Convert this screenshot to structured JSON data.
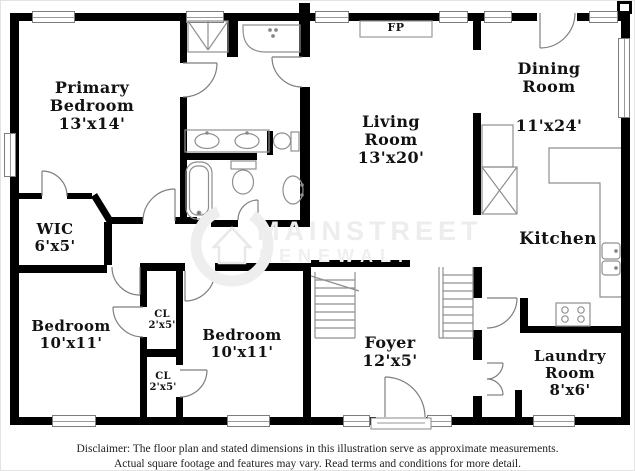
{
  "colors": {
    "wall": "#000000",
    "fixture_line": "#8f8f8f",
    "watermark": "#ededed",
    "label_text": "#121212"
  },
  "watermark": {
    "line1": "MAINSTREET",
    "line2": "RENEWAL."
  },
  "fireplace": {
    "label": "FP"
  },
  "rooms": {
    "primary_bedroom": {
      "name1": "Primary",
      "name2": "Bedroom",
      "dims": "13'x14'"
    },
    "wic": {
      "name1": "WIC",
      "dims": "6'x5'"
    },
    "bedroom_left": {
      "name1": "Bedroom",
      "dims": "10'x11'"
    },
    "bedroom_right": {
      "name1": "Bedroom",
      "dims": "10'x11'"
    },
    "closet_upper": {
      "name1": "CL",
      "dims": "2'x5'"
    },
    "closet_lower": {
      "name1": "CL",
      "dims": "2'x5'"
    },
    "living_room": {
      "name1": "Living",
      "name2": "Room",
      "dims": "13'x20'"
    },
    "dining_room": {
      "name1": "Dining",
      "name2": "Room",
      "dims": "11'x24'"
    },
    "kitchen": {
      "name1": "Kitchen"
    },
    "foyer": {
      "name1": "Foyer",
      "dims": "12'x5'"
    },
    "laundry_room": {
      "name1": "Laundry",
      "name2": "Room",
      "dims": "8'x6'"
    }
  },
  "disclaimer": {
    "line1": "Disclaimer: The floor plan and stated dimensions in this illustration serve as approximate measurements.",
    "line2": "Actual square footage and features may vary. Read terms and conditions for more detail."
  }
}
